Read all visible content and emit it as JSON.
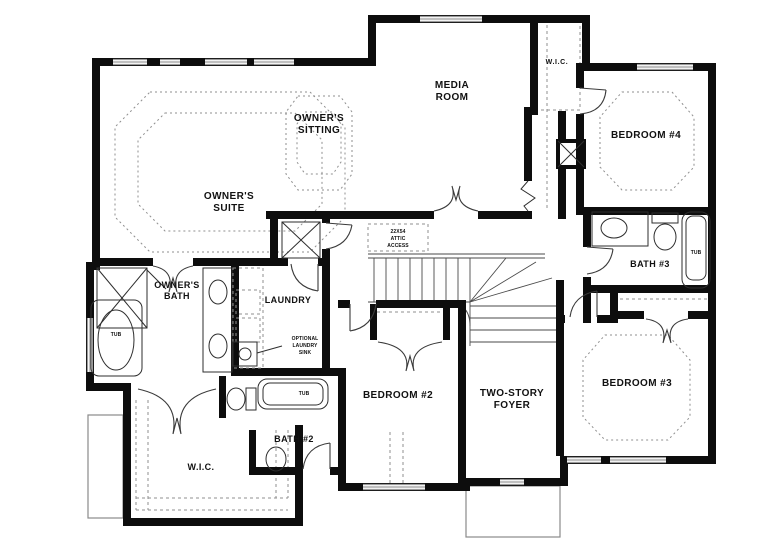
{
  "drawing": {
    "type": "floor-plan",
    "background": "#ffffff",
    "wall_color": "#0d0d0d",
    "window_color": "#9a9a9a",
    "line_color": "#3a3a3a"
  },
  "rooms": {
    "owners_suite": {
      "line1": "OWNER'S",
      "line2": "SUITE"
    },
    "owners_sitting": {
      "line1": "OWNER'S",
      "line2": "SITTING"
    },
    "media_room": {
      "line1": "MEDIA",
      "line2": "ROOM"
    },
    "wic_upper": {
      "label": "W.I.C."
    },
    "bedroom_4": {
      "label": "BEDROOM #4"
    },
    "bath_3": {
      "label": "BATH #3"
    },
    "bedroom_3": {
      "label": "BEDROOM #3"
    },
    "foyer": {
      "line1": "TWO-STORY",
      "line2": "FOYER"
    },
    "bedroom_2": {
      "label": "BEDROOM #2"
    },
    "bath_2": {
      "label": "BATH #2"
    },
    "wic_lower": {
      "label": "W.I.C."
    },
    "laundry": {
      "label": "LAUNDRY"
    },
    "owners_bath": {
      "line1": "OWNER'S",
      "line2": "BATH"
    }
  },
  "fixtures": {
    "tub_owners": "TUB",
    "tub_bath2": "TUB",
    "tub_bath3": "TUB"
  },
  "notes": {
    "attic": {
      "line1": "22X54",
      "line2": "ATTIC",
      "line3": "ACCESS"
    },
    "optional_sink": {
      "line1": "OPTIONAL",
      "line2": "LAUNDRY",
      "line3": "SINK"
    }
  }
}
